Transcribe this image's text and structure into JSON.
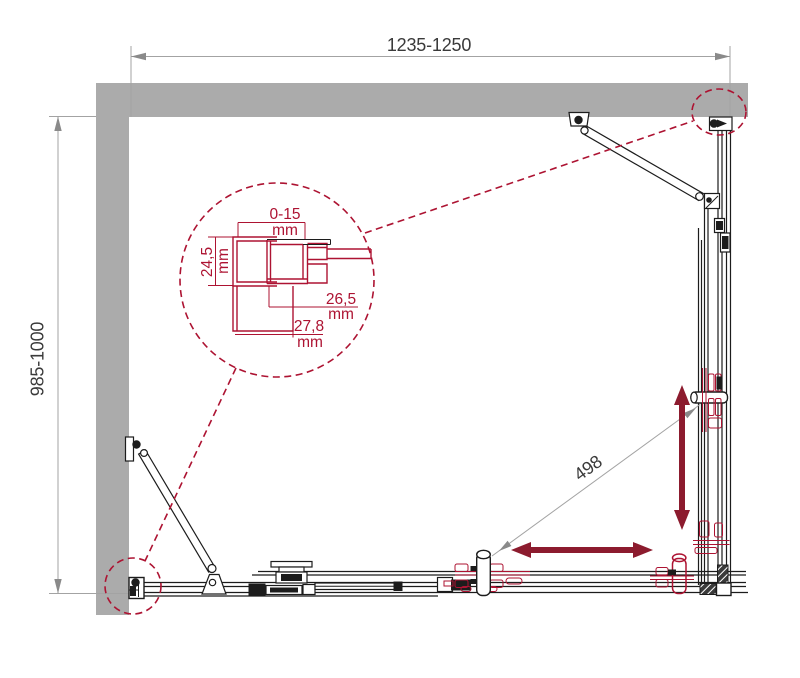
{
  "drawing": {
    "type": "shower-enclosure-installation-diagram",
    "dimensions": {
      "width": "1235-1250",
      "depth": "985-1000",
      "door_travel": "498"
    },
    "detail": {
      "adjustment_value": "0-15",
      "adjustment_unit": "mm",
      "profile_depth_value": "24,5",
      "profile_depth_unit": "mm",
      "offset_value": "26,5",
      "offset_unit": "mm",
      "base_value": "27,8",
      "base_unit": "mm"
    },
    "colors": {
      "wall_gray": "#ababab",
      "frame_black": "#1c1c1c",
      "annotation_red": "#ad1332",
      "arrow_red": "#8c1b2e",
      "dimension_gray": "#9a9a9a",
      "dimension_text": "#3a3a3a"
    }
  }
}
